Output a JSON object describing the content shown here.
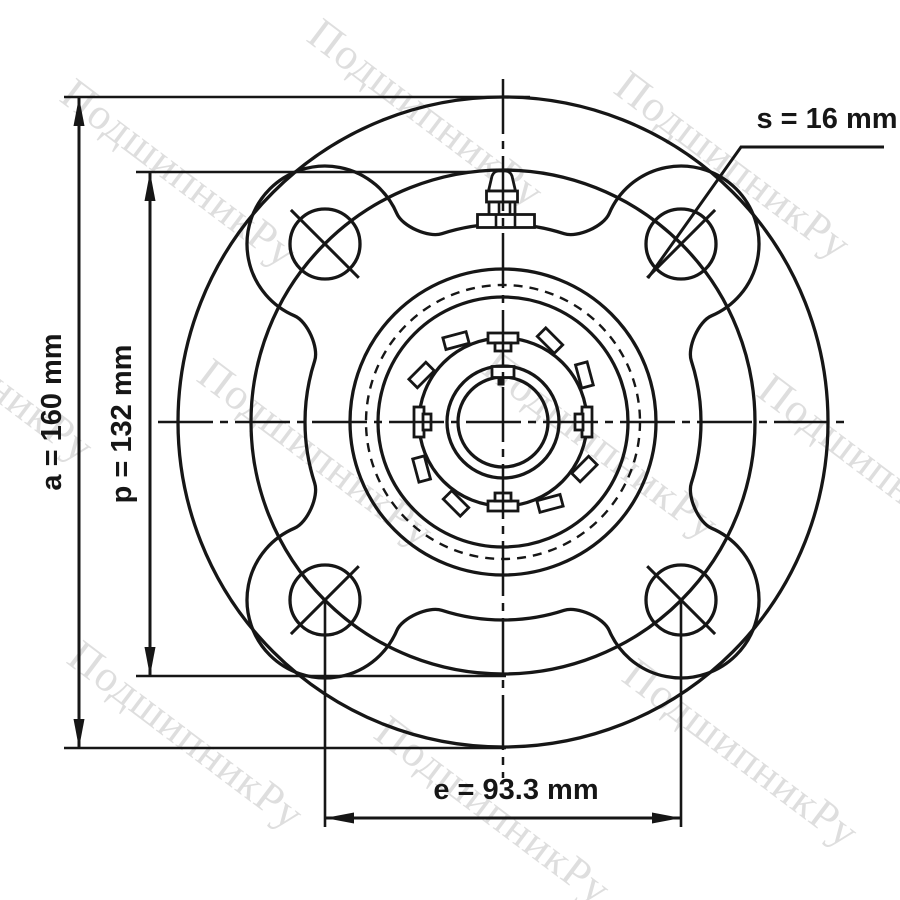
{
  "page": {
    "background": "#ffffff",
    "line_color": "#161616"
  },
  "watermark": {
    "text": "ПодшипникРу",
    "color": "#c9c9c9"
  },
  "dimensions": {
    "a": {
      "label": "a = 160 mm",
      "value_mm": 160
    },
    "p": {
      "label": "p = 132 mm",
      "value_mm": 132
    },
    "s": {
      "label": "s = 16 mm",
      "value_mm": 16
    },
    "e": {
      "label": "e = 93.3 mm",
      "value_mm": 93.3
    }
  }
}
